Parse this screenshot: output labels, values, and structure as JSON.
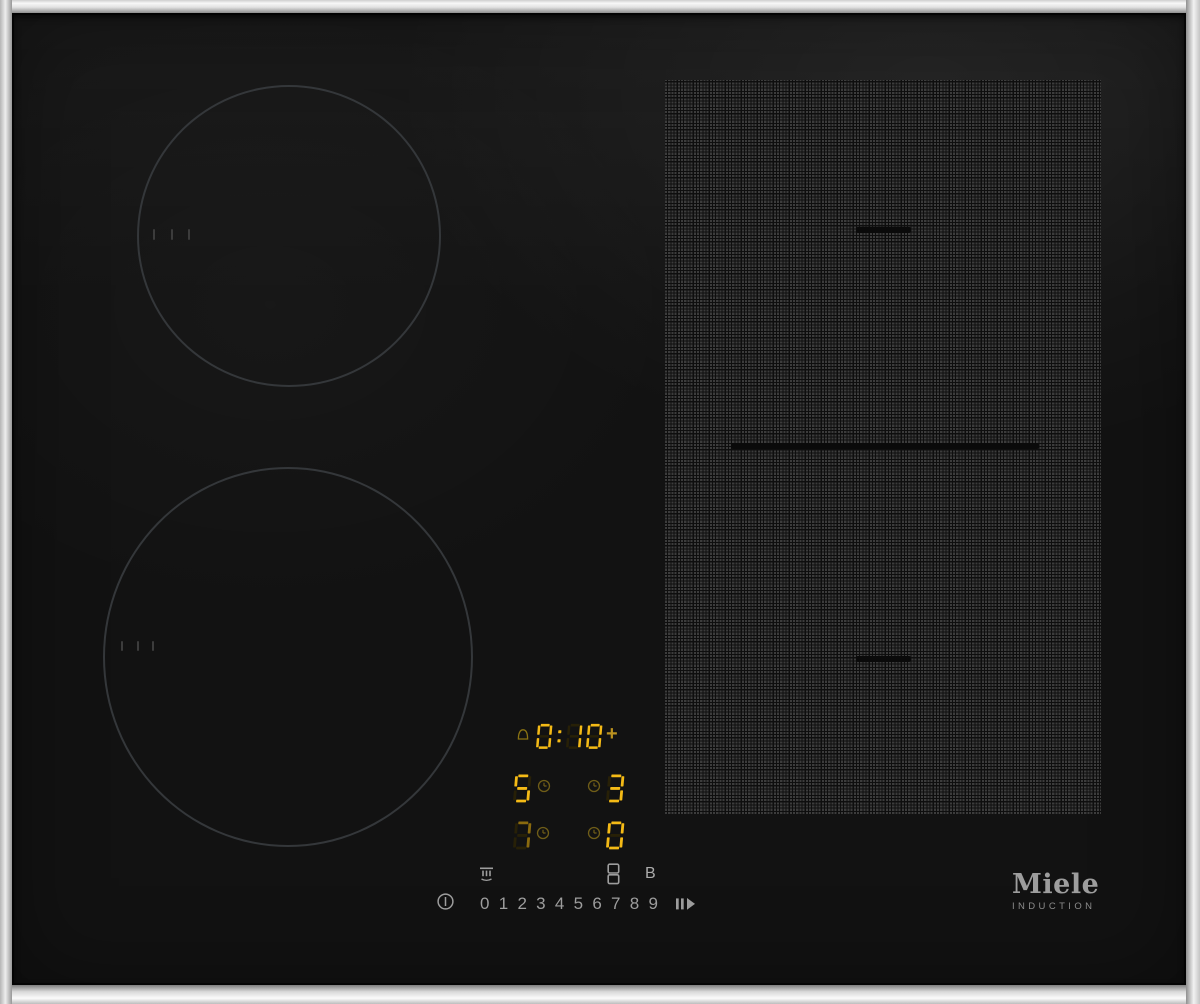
{
  "display": {
    "timer": {
      "value": "0:10",
      "plus": "+"
    },
    "zones": [
      {
        "left": {
          "char": "5",
          "level": "bright"
        },
        "right": {
          "char": "3",
          "level": "bright"
        }
      },
      {
        "left": {
          "char": "7",
          "level": "dim"
        },
        "right": {
          "char": "0",
          "level": "bright"
        }
      }
    ]
  },
  "controls": {
    "keys": [
      "0",
      "1",
      "2",
      "3",
      "4",
      "5",
      "6",
      "7",
      "8",
      "9"
    ],
    "booster": "B"
  },
  "brand": {
    "name": "Miele",
    "tagline": "INDUCTION"
  },
  "colors": {
    "seg_lit": "#f4ba16",
    "seg_dim": "#8a6a0e",
    "seg_ghost": "#272007",
    "icon_gold": "#6f5d18",
    "bell_gold": "#8a7313",
    "plus_gold": "#bb9220",
    "control_gray": "#9d9d9d",
    "grid_dot": "#3c3c3c"
  }
}
